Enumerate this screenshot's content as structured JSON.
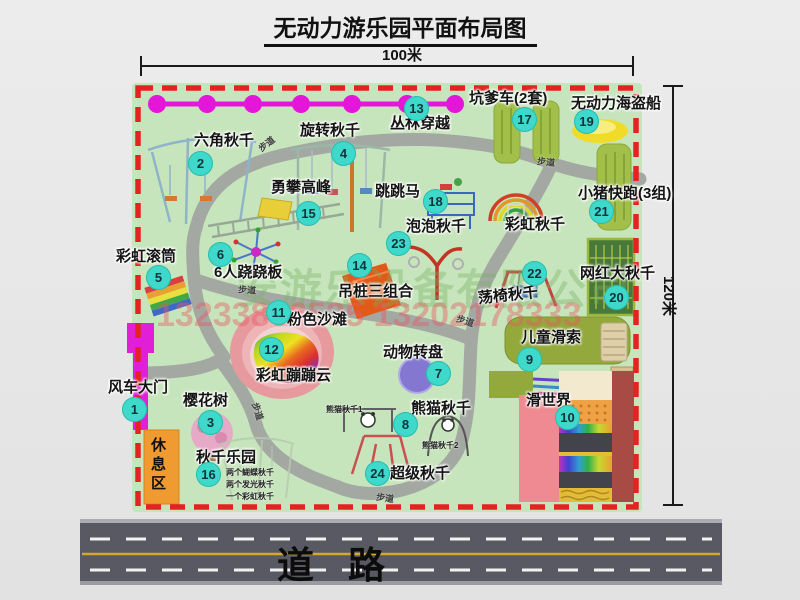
{
  "title": "无动力游乐园平面布局图",
  "dimensions": {
    "width_label": "100米",
    "height_label": "120米"
  },
  "road": {
    "label": "道路"
  },
  "watermark": {
    "company": "安游乐设备有限公司",
    "phone": "13233806535 13202178333"
  },
  "path_label": "步道",
  "zones": {
    "rest_area": "休息区",
    "rainbow_swing": "彩虹秋千"
  },
  "attractions": [
    {
      "id": "1",
      "name": "风车大门"
    },
    {
      "id": "2",
      "name": "六角秋千"
    },
    {
      "id": "3",
      "name": "樱花树"
    },
    {
      "id": "4",
      "name": "旋转秋千"
    },
    {
      "id": "5",
      "name": "彩虹滚筒"
    },
    {
      "id": "6",
      "name": "6人跷跷板"
    },
    {
      "id": "7",
      "name": "动物转盘"
    },
    {
      "id": "8",
      "name": "熊猫秋千",
      "notes": [
        "熊猫秋千1",
        "熊猫秋千2"
      ]
    },
    {
      "id": "9",
      "name": "儿童滑索"
    },
    {
      "id": "10",
      "name": "滑世界"
    },
    {
      "id": "11",
      "name": "粉色沙滩"
    },
    {
      "id": "12",
      "name": "彩虹蹦蹦云"
    },
    {
      "id": "13",
      "name": "丛林穿越"
    },
    {
      "id": "14",
      "name": "吊桩三组合"
    },
    {
      "id": "15",
      "name": "勇攀高峰"
    },
    {
      "id": "16",
      "name": "秋千乐园",
      "notes": [
        "两个蝴蝶秋千",
        "两个发光秋千",
        "一个彩虹秋千"
      ]
    },
    {
      "id": "17",
      "name": "坑爹车(2套)"
    },
    {
      "id": "18",
      "name": "跳跳马"
    },
    {
      "id": "19",
      "name": "无动力海盗船"
    },
    {
      "id": "20",
      "name": "网红大秋千"
    },
    {
      "id": "21",
      "name": "小猪快跑(3组)"
    },
    {
      "id": "22",
      "name": "荡椅秋千"
    },
    {
      "id": "23",
      "name": "泡泡秋千"
    },
    {
      "id": "24",
      "name": "超级秋千"
    }
  ]
}
